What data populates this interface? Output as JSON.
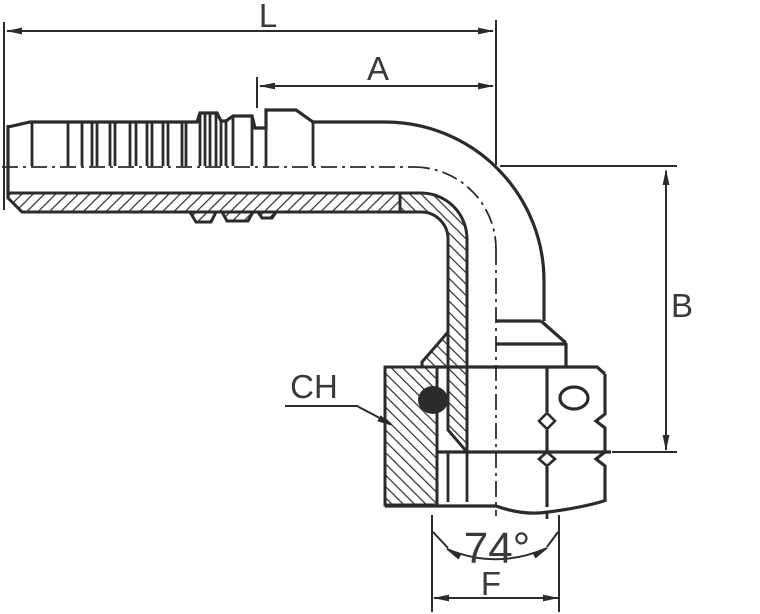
{
  "diagram": {
    "labels": {
      "l": "L",
      "a": "A",
      "b": "B",
      "ch": "CH",
      "f": "F",
      "angle": "74°"
    }
  },
  "colors": {
    "line": "#2b2b2b",
    "label_text": "#3a3a3a",
    "background": "#ffffff"
  }
}
